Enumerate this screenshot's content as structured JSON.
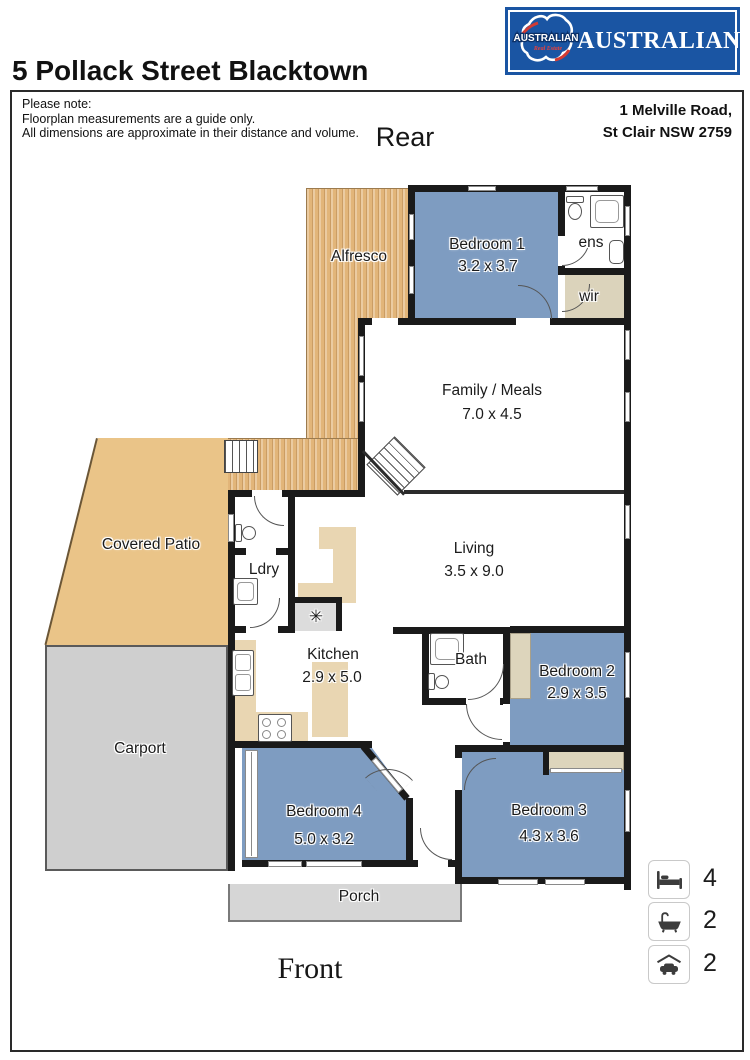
{
  "header": {
    "title": "5 Pollack Street Blacktown"
  },
  "logo": {
    "brand": "AUSTRALIAN",
    "emblem_top": "AUSTRALIAN",
    "emblem_bottom": "Real Estate"
  },
  "note": {
    "line1": "Please note:",
    "line2": "Floorplan measurements are a guide only.",
    "line3": "All dimensions are approximate in their distance and volume."
  },
  "address": {
    "line1": "1 Melville Road,",
    "line2": "St Clair NSW 2759"
  },
  "orientation": {
    "rear": "Rear",
    "front": "Front"
  },
  "rooms": {
    "alfresco": {
      "label": "Alfresco"
    },
    "bedroom1": {
      "label": "Bedroom 1",
      "dims": "3.2 x 3.7"
    },
    "ens": {
      "label": "ens"
    },
    "wir": {
      "label": "wir"
    },
    "family": {
      "label": "Family / Meals",
      "dims": "7.0 x 4.5"
    },
    "living": {
      "label": "Living",
      "dims": "3.5 x 9.0"
    },
    "covered_patio": {
      "label": "Covered Patio"
    },
    "ldry": {
      "label": "Ldry"
    },
    "kitchen": {
      "label": "Kitchen",
      "dims": "2.9 x 5.0"
    },
    "bath": {
      "label": "Bath"
    },
    "bedroom2": {
      "label": "Bedroom 2",
      "dims": "2.9 x 3.5"
    },
    "carport": {
      "label": "Carport"
    },
    "bedroom4": {
      "label": "Bedroom 4",
      "dims": "5.0 x 3.2"
    },
    "bedroom3": {
      "label": "Bedroom 3",
      "dims": "4.3 x 3.6"
    },
    "porch": {
      "label": "Porch"
    }
  },
  "symbols": {
    "hot_water": "✳"
  },
  "summary": {
    "beds": "4",
    "baths": "2",
    "cars": "2"
  },
  "colors": {
    "bedroom_fill": "#7e9cc1",
    "deck_fill": "#e2b579",
    "patio_fill": "#eac488",
    "robe_fill": "#ddd5bc",
    "carport_fill": "#cfcfcf",
    "logo_blue": "#1a55a3",
    "logo_red": "#d23b34"
  }
}
